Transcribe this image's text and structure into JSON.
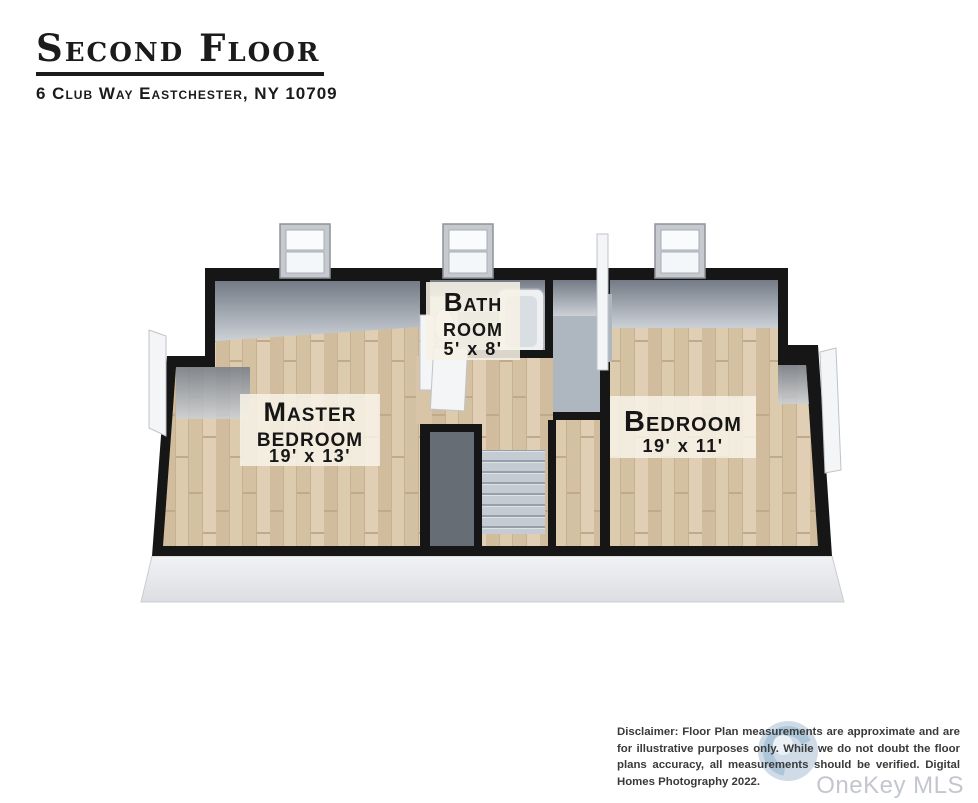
{
  "header": {
    "title": "Second Floor",
    "subtitle": "6 Club Way Eastchester, NY 10709"
  },
  "plan": {
    "rooms": {
      "master": {
        "name_line1": "Master",
        "name_line2": "bedroom",
        "dims": "19' x 13'"
      },
      "bath": {
        "name_line1": "Bath",
        "name_line2": "room",
        "dims": "5' x 8'"
      },
      "bedroom": {
        "name_line1": "Bedroom",
        "dims": "19' x 11'"
      }
    },
    "colors": {
      "wall": "#161616",
      "wood_floor": "#d8c5a7",
      "stairs": "#c4cbd3",
      "label_bg": "#f6f1e6",
      "logo_blue": "#c7d7e4"
    }
  },
  "footer": {
    "disclaimer": "Disclaimer: Floor Plan measurements are approximate and are for illustrative purposes only. While we do not doubt the floor plans accuracy, all measurements should be verified. Digital Homes Photography 2022.",
    "watermark": "OneKey MLS"
  }
}
